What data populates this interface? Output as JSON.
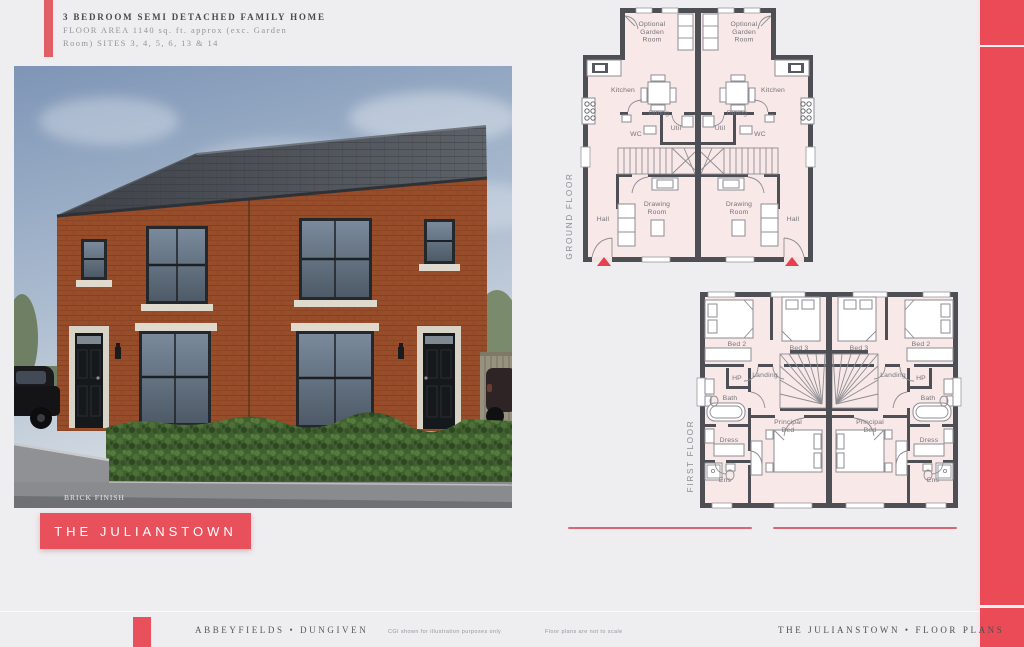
{
  "accent": {
    "red": "#E8505C"
  },
  "header": {
    "line1": "3 BEDROOM SEMI DETACHED FAMILY HOME",
    "line2": "FLOOR AREA 1140 sq. ft. approx (exc. Garden",
    "line3": "Room) SITES 3, 4, 5, 6, 13 & 14"
  },
  "cgi": {
    "finish_label": "BRICK FINISH"
  },
  "banner": {
    "label": "THE JULIANSTOWN"
  },
  "plans": {
    "ground": {
      "label": "GROUND FLOOR",
      "rooms": {
        "garden": "Optional\nGarden\nRoom",
        "kitchen": "Kitchen",
        "dining": "Dining",
        "util": "Util",
        "wc": "WC",
        "drawing": "Drawing\nRoom",
        "hall": "Hall"
      }
    },
    "first": {
      "label": "FIRST FLOOR",
      "rooms": {
        "bed2": "Bed 2",
        "bed3": "Bed 3",
        "hp": "HP",
        "landing": "Landing",
        "bath": "Bath",
        "dress": "Dress",
        "principal": "Principal\nBed",
        "ens": "Ens"
      }
    }
  },
  "footer": {
    "left": "ABBEYFIELDS • DUNGIVEN",
    "note_cgi": "CGI shown for illustration purposes only",
    "note_scale": "Floor plans are not to scale",
    "right": "THE JULIANSTOWN • FLOOR PLANS"
  }
}
